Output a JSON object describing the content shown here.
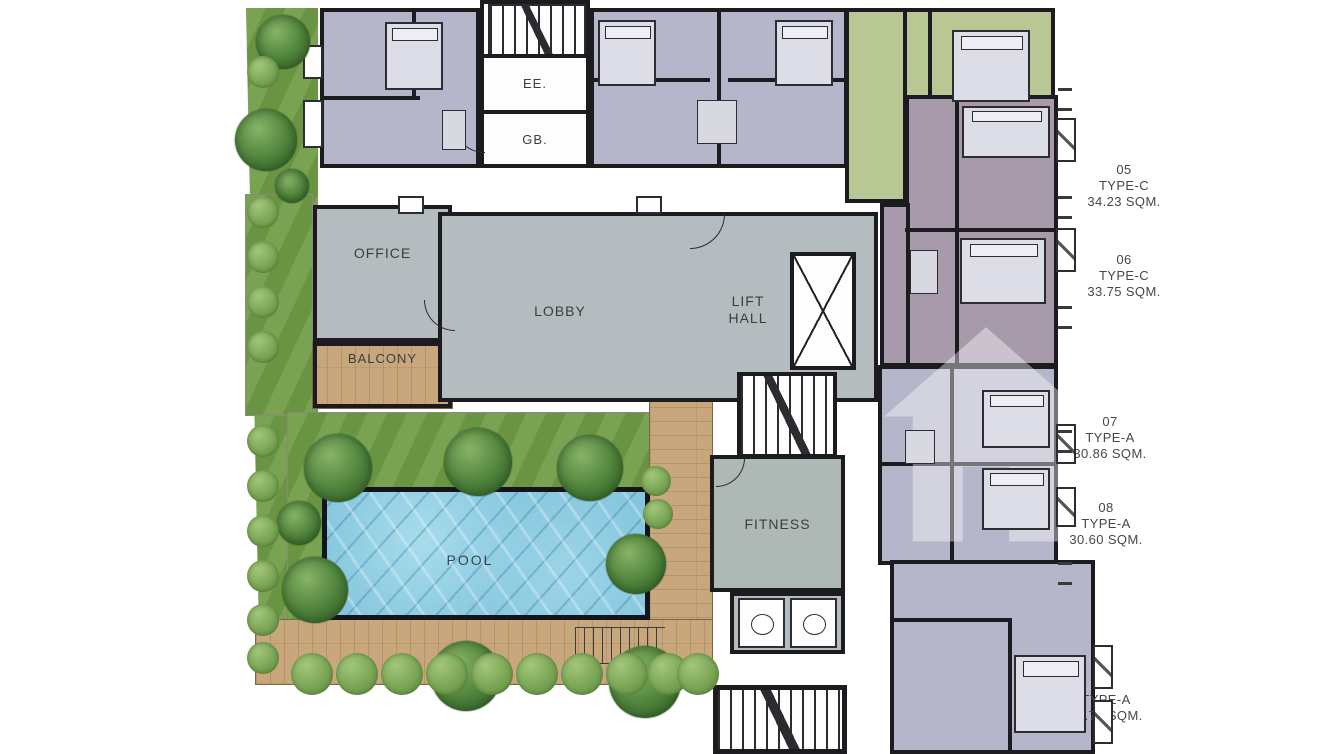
{
  "rooms": {
    "office": {
      "label": "OFFICE"
    },
    "balcony": {
      "label": "BALCONY"
    },
    "lobby": {
      "label": "LOBBY"
    },
    "lift_hall": {
      "line1": "LIFT",
      "line2": "HALL"
    },
    "pool": {
      "label": "POOL"
    },
    "fitness": {
      "label": "FITNESS"
    },
    "ee": {
      "label": "EE."
    },
    "gb": {
      "label": "GB."
    }
  },
  "units": [
    {
      "number": "05",
      "type": "TYPE-C",
      "area": "34.23 SQM."
    },
    {
      "number": "06",
      "type": "TYPE-C",
      "area": "33.75 SQM."
    },
    {
      "number": "07",
      "type": "TYPE-A",
      "area": "30.86 SQM."
    },
    {
      "number": "08",
      "type": "TYPE-A",
      "area": "30.60 SQM."
    },
    {
      "number": "09",
      "type": "TYPE-A",
      "area": "30.78 SQM."
    }
  ],
  "colors": {
    "wall": "#1b1b20",
    "lavender": "#b5b6c9",
    "mauve": "#a79aab",
    "green_unit": "#b9c795",
    "common_gray": "#b4bcc0",
    "fitness_gray": "#aeb8b4",
    "wood": "#c9a77d",
    "grass": "#6f9c45",
    "pool_water": "#85c6de",
    "label_text": "#3d3d40"
  }
}
